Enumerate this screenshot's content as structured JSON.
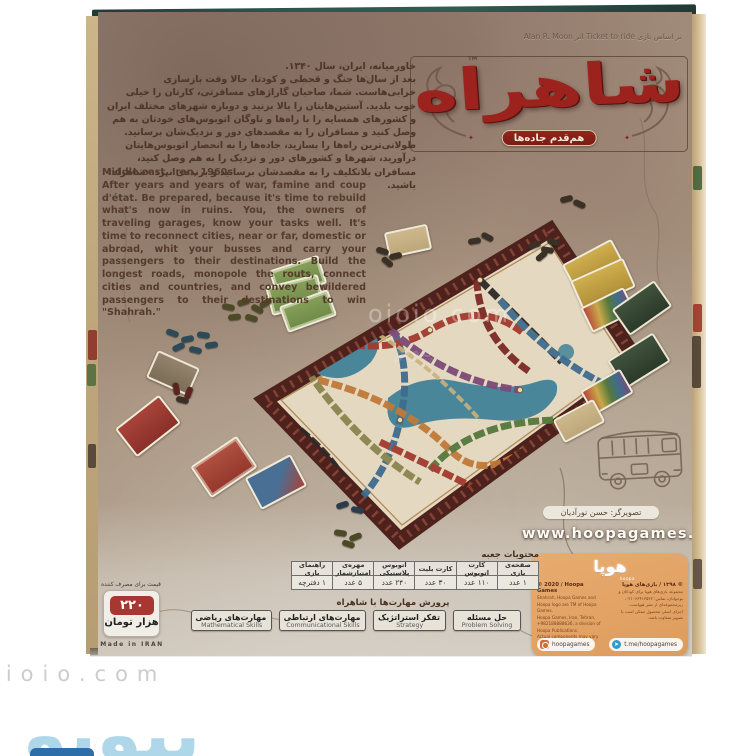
{
  "palette": {
    "accent_red": "#9c231d",
    "parchment": "#a8937f",
    "board_cream": "#e4d9c0",
    "water_teal": "#4a8699",
    "publisher_orange": "#e2a266",
    "price_red": "#a83732",
    "top_edge_teal": "#2c564a",
    "watermark_blue": "#aed7ea"
  },
  "box_back": {
    "based_on_line": "بر اساس بازی Ticket to ride اثر Alan R. Moon",
    "logo": {
      "title": "شاهراه",
      "tm": "TM",
      "tagline": "هم‌قدم جاده‌ها",
      "ornament": "✦"
    },
    "intro_fa": {
      "line1": "خاورمیانه، ایران، سال ۱۳۴۰.",
      "body": "بعد از سال‌ها جنگ و قحطی و کودتا، حالا وقت بازسازی خرابی‌هاست. شما، صاحبان گاراژهای مسافرتی، کارتان را خیلی خوب بلدید. آستین‌هایتان را بالا بزنید و دوباره شهرهای مختلف ایران و کشورهای همسایه را با راه‌ها و ناوگان اتوبوس‌های خودتان به هم وصل کنید و مسافران را به مقصدهای دور و نزدیک‌شان برسانید. طولانی‌ترین راه‌ها را بسازید، جاده‌ها را به انحصار اتوبوس‌هایتان درآورید، شهرها و کشورهای دور و نزدیک را به هم وصل کنید، مسافران بلاتکلیف را به مقصدشان برسانید و برنده‌ی نبرد «شاهراه» باشید."
    },
    "intro_en": {
      "line1": "Middle east, Iran, 1960s.",
      "body": "After years and years of war, famine and coup d'état. Be prepared, because it's time to rebuild what's now in ruins. You, the owners of traveling garages, know your tasks well. It's time to reconnect cities, near or far, domestic or abroad, whit your busses and carry your passengers to their destinations. Build the longest roads, monopole the routs, connect cities and countries, and convey bewildered passengers to their destinations to win \"Shahrah.\""
    },
    "contents": {
      "title": "محتویات جعبه",
      "columns": [
        {
          "label": "صفحه‌ی بازی",
          "value": "۱ عدد"
        },
        {
          "label": "کارت اتوبوس",
          "value": "۱۱۰ عدد"
        },
        {
          "label": "کارت بلیت",
          "value": "۳۰ عدد"
        },
        {
          "label": "اتوبوس پلاستیکی",
          "value": "۲۴۰ عدد"
        },
        {
          "label": "مهره‌ی امتیازشمار",
          "value": "۵ عدد"
        },
        {
          "label": "راهنمای بازی",
          "value": "۱ دفترچه"
        }
      ]
    },
    "skills": {
      "title": "پرورش مهارت‌ها با شاهراه",
      "items": [
        {
          "fa": "حل مسئله",
          "en": "Problem Solving"
        },
        {
          "fa": "تفکر استراتژیک",
          "en": "Strategy"
        },
        {
          "fa": "مهارت‌های ارتباطی",
          "en": "Communicational Skills"
        },
        {
          "fa": "مهارت‌های ریاضی",
          "en": "Mathematical Skills"
        }
      ]
    },
    "price": {
      "note": "قیمت برای مصرف کننده",
      "amount": "۲۲۰",
      "unit": "هزار تومان",
      "made_in": "Made in IRAN"
    },
    "illustrator": "تصویرگر: حسن نورآدیان",
    "website": "www.hoopagames.ir",
    "publisher_card": {
      "logo_fa": "هوپا",
      "logo_en": "hoopa",
      "copy_en_title": "© 2020 / Hoopa Games",
      "copy_en_lines": [
        "Shahrah, Hoopa Games and Hoopa logo are TM of Hoopa Games.",
        "Hoopa Games, Iran, Tehran, +982188888636, a division of Hoopa Publications.",
        "Actual components may vary from those shown."
      ],
      "copy_fa_title": "© ۱۳۹۸ / بازی‌های هوپا",
      "copy_fa_lines": [
        "مجموعه بازی‌های هوپا برای کودکان و نوجوانان، تماس: ۶۶۴۱۳۵۳۲–۰۲۱،",
        "زیرمجموعه‌ای از نشر هوپاست.",
        "اجزای اصلی محصول ممکن است با تصویر متفاوت باشد."
      ],
      "instagram": "hoopagames",
      "telegram": "t.me/hoopagames",
      "telegram_glyph": "➤"
    }
  },
  "watermark": {
    "center": "oioio.com",
    "center2": "پیویو",
    "bottom_text": "oioio.com",
    "bottom_logo": "پیویو"
  }
}
